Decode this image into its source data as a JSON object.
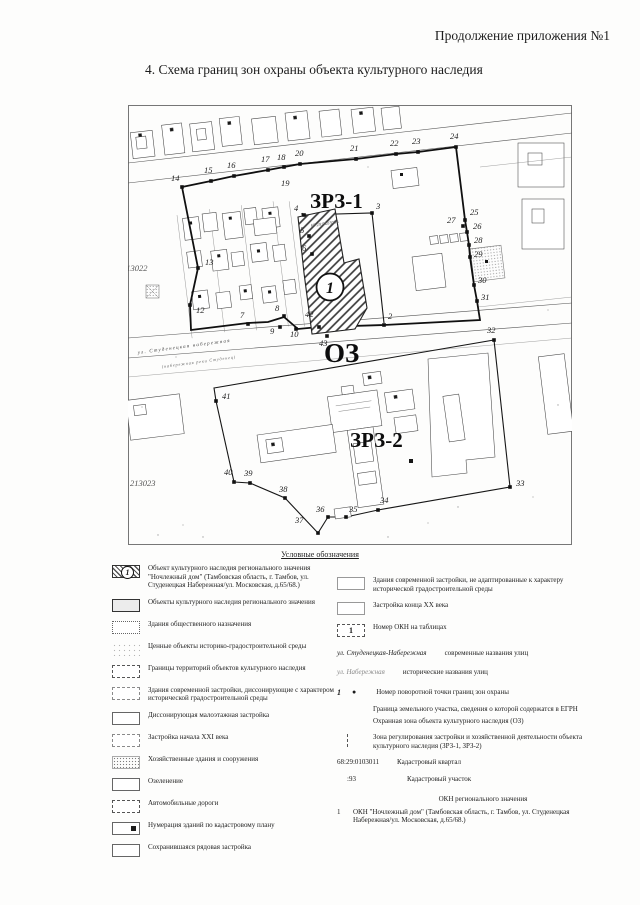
{
  "page": {
    "header_right": "Продолжение приложения №1",
    "section_title": "4. Схема границ зон охраны объекта культурного наследия"
  },
  "map": {
    "zones": {
      "zrz1": "ЗРЗ-1",
      "oz": "ОЗ",
      "zrz2": "ЗРЗ-2"
    },
    "okn_circle_number": "1",
    "okn_parcel_label": "68:29:0103056",
    "cadastral_quarter_left": "213022",
    "cadastral_quarter_bottom": "213023",
    "street_label_line1": "ул. Студенецкая набережная",
    "street_label_line2": "(набережная реки Студенец)",
    "points": [
      {
        "n": "2",
        "x": 256,
        "y": 220,
        "lx": 260,
        "ly": 214
      },
      {
        "n": "3",
        "x": 244,
        "y": 108,
        "lx": 248,
        "ly": 104
      },
      {
        "n": "4",
        "x": 176,
        "y": 110,
        "lx": 166,
        "ly": 106
      },
      {
        "n": "5",
        "x": 181,
        "y": 131,
        "lx": 172,
        "ly": 128
      },
      {
        "n": "6",
        "x": 184,
        "y": 149,
        "lx": 174,
        "ly": 146
      },
      {
        "n": "7",
        "x": 120,
        "y": 219,
        "lx": 112,
        "ly": 213
      },
      {
        "n": "8",
        "x": 156,
        "y": 211,
        "lx": 147,
        "ly": 206
      },
      {
        "n": "9",
        "x": 152,
        "y": 222,
        "lx": 142,
        "ly": 229
      },
      {
        "n": "10",
        "x": 168,
        "y": 224,
        "lx": 162,
        "ly": 232
      },
      {
        "n": "12",
        "x": 62,
        "y": 200,
        "lx": 68,
        "ly": 208
      },
      {
        "n": "13",
        "x": 70,
        "y": 163,
        "lx": 77,
        "ly": 160
      },
      {
        "n": "14",
        "x": 54,
        "y": 82,
        "lx": 43,
        "ly": 76
      },
      {
        "n": "15",
        "x": 83,
        "y": 76,
        "lx": 76,
        "ly": 68
      },
      {
        "n": "16",
        "x": 106,
        "y": 71,
        "lx": 99,
        "ly": 63
      },
      {
        "n": "17",
        "x": 140,
        "y": 65,
        "lx": 133,
        "ly": 57
      },
      {
        "n": "18",
        "x": 156,
        "y": 62,
        "lx": 149,
        "ly": 55
      },
      {
        "n": "19",
        "dot": false,
        "lx": 153,
        "ly": 81
      },
      {
        "n": "20",
        "x": 172,
        "y": 59,
        "lx": 167,
        "ly": 51
      },
      {
        "n": "21",
        "x": 228,
        "y": 54,
        "lx": 222,
        "ly": 46
      },
      {
        "n": "22",
        "x": 268,
        "y": 49,
        "lx": 262,
        "ly": 41
      },
      {
        "n": "23",
        "x": 290,
        "y": 47,
        "lx": 284,
        "ly": 39
      },
      {
        "n": "24",
        "x": 328,
        "y": 42,
        "lx": 322,
        "ly": 34
      },
      {
        "n": "25",
        "x": 337,
        "y": 115,
        "lx": 342,
        "ly": 110
      },
      {
        "n": "26",
        "x": 339,
        "y": 127,
        "lx": 345,
        "ly": 124
      },
      {
        "n": "27",
        "x": 335,
        "y": 121,
        "lx": 319,
        "ly": 118
      },
      {
        "n": "28",
        "x": 341,
        "y": 140,
        "lx": 346,
        "ly": 138
      },
      {
        "n": "29",
        "x": 342,
        "y": 152,
        "lx": 346,
        "ly": 152
      },
      {
        "n": "30",
        "x": 346,
        "y": 180,
        "lx": 350,
        "ly": 178
      },
      {
        "n": "31",
        "x": 349,
        "y": 196,
        "lx": 353,
        "ly": 195
      },
      {
        "n": "32",
        "x": 366,
        "y": 235,
        "lx": 359,
        "ly": 228
      },
      {
        "n": "33",
        "x": 382,
        "y": 382,
        "lx": 388,
        "ly": 381
      },
      {
        "n": "34",
        "x": 250,
        "y": 405,
        "lx": 252,
        "ly": 398
      },
      {
        "n": "35",
        "x": 218,
        "y": 412,
        "lx": 221,
        "ly": 407
      },
      {
        "n": "36",
        "x": 200,
        "y": 412,
        "lx": 188,
        "ly": 407
      },
      {
        "n": "37",
        "x": 190,
        "y": 428,
        "lx": 167,
        "ly": 418
      },
      {
        "n": "38",
        "x": 157,
        "y": 393,
        "lx": 151,
        "ly": 387
      },
      {
        "n": "39",
        "x": 122,
        "y": 378,
        "lx": 116,
        "ly": 371
      },
      {
        "n": "40",
        "x": 106,
        "y": 377,
        "lx": 96,
        "ly": 370
      },
      {
        "n": "41",
        "x": 88,
        "y": 296,
        "lx": 94,
        "ly": 294
      },
      {
        "n": "42",
        "x": 191,
        "y": 222,
        "lx": 177,
        "ly": 212
      },
      {
        "n": "43",
        "x": 199,
        "y": 231,
        "lx": 191,
        "ly": 241
      }
    ]
  },
  "legend": {
    "heading": "Условные обозначения",
    "left_items": [
      {
        "icon_number": "1",
        "text": "Объект культурного наследия регионального значения \"Ночлежный дом\" (Тамбовская область, г. Тамбов, ул. Студенецкая Набережная/ул. Московская, д.65/68.)"
      },
      {
        "text": "Объекты культурного наследия регионального значения"
      },
      {
        "text": "Здания общественного назначения"
      },
      {
        "text": "Ценные объекты историко-градостроительной среды"
      },
      {
        "text": "Границы территорий объектов культурного наследия"
      },
      {
        "text": "Здания современной застройки, диссонирующие с характером исторической градостроительной среды"
      },
      {
        "text": "Диссонирующая малоэтажная застройка"
      },
      {
        "text": "Застройка начала XXI века"
      },
      {
        "text": "Хозяйственные здания и сооружения"
      },
      {
        "text": "Озеленение"
      },
      {
        "text": "Автомобильные дороги"
      },
      {
        "text": "Нумерация зданий по кадастровому плану"
      },
      {
        "text": "Сохранившаяся рядовая застройка"
      }
    ],
    "right_items": [
      {
        "text": "Здания современной застройки, не адаптированные к характеру исторической градостроительной среды"
      },
      {
        "text": "Застройка конца XX века"
      },
      {
        "icon_number": "1",
        "text": "Номер ОКН на таблицах"
      },
      {
        "sample": "ул. Студенецкая-Набережная",
        "text": "современные названия улиц"
      },
      {
        "sample": "ул. Набережная",
        "text": "исторические названия улиц"
      },
      {
        "num": "1",
        "dot": "●",
        "text": "Номер поворотной точки границ зон охраны"
      },
      {
        "text": "Граница земельного участка, сведения о которой содержатся в ЕГРН"
      },
      {
        "text": "Охранная зона объекта культурного наследия (ОЗ)"
      },
      {
        "text": "Зона регулирования застройки и хозяйственной деятельности объекта культурного наследия (ЗРЗ-1, ЗРЗ-2)"
      },
      {
        "num": "68:29:0103011",
        "text": "Кадастровый квартал"
      },
      {
        "num": ":93",
        "text": "Кадастровый участок"
      },
      {
        "text": "ОКН регионального значения"
      },
      {
        "num": "1",
        "text": "ОКН \"Ночлежный дом\" (Тамбовская область, г. Тамбов, ул. Студенецкая Набережная/ул. Московская, д.65/68.)"
      }
    ]
  }
}
